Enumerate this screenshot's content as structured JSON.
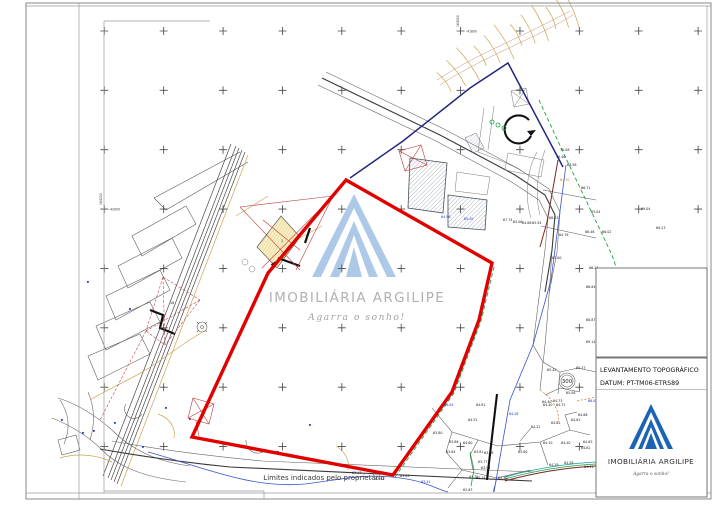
{
  "page": {
    "footer_note": "Limites indicados pelo proprietário",
    "coordinates": {
      "top_vertical": "164300",
      "top_horizontal": "-41800",
      "left_vertical": "164200",
      "left_horizontal": "-42000"
    }
  },
  "watermark": {
    "brand": "IMOBILIÁRIA ARGILIPE",
    "tagline": "Agarra o sonho!"
  },
  "title_block": {
    "doc_type": "LEVANTAMENTO TOPOGRÁFICO",
    "datum": "DATUM: PT-TM06-ETRS89",
    "brand": "IMOBILIÁRIA ARGILIPE",
    "tagline": "Agarra o sonho!"
  },
  "map": {
    "station_label": "300",
    "parcel_number": "16",
    "building_number": "1",
    "grid": {
      "x0": 104.3,
      "y0": 31,
      "dx": 59.38,
      "dy": 59.36,
      "cols": 11,
      "rows": 8,
      "skip_x": 590,
      "skip_y": 262,
      "max_x": 707,
      "max_y": 488,
      "half": 4
    },
    "elevation_labels": [
      {
        "t": "70.08",
        "x": 560,
        "y": 151
      },
      {
        "t": "70.46",
        "x": 556,
        "y": 158
      },
      {
        "t": "68.58",
        "x": 567,
        "y": 166
      },
      {
        "t": "64.70",
        "x": 560,
        "y": 181,
        "c": "o"
      },
      {
        "t": "66.71",
        "x": 581,
        "y": 189
      },
      {
        "t": "68.23",
        "x": 549,
        "y": 219
      },
      {
        "t": "65.04",
        "x": 591,
        "y": 213
      },
      {
        "t": "66.46",
        "x": 585,
        "y": 233
      },
      {
        "t": "66.02",
        "x": 602,
        "y": 233
      },
      {
        "t": "64.76",
        "x": 559,
        "y": 236
      },
      {
        "t": "67.00",
        "x": 552,
        "y": 259
      },
      {
        "t": "66.27",
        "x": 589,
        "y": 269
      },
      {
        "t": "67.74",
        "x": 503,
        "y": 221
      },
      {
        "t": "65.06",
        "x": 513,
        "y": 223
      },
      {
        "t": "64.86",
        "x": 522,
        "y": 224
      },
      {
        "t": "65.94",
        "x": 532,
        "y": 224
      },
      {
        "t": "66.84",
        "x": 586,
        "y": 288
      },
      {
        "t": "68.87",
        "x": 586,
        "y": 321
      },
      {
        "t": "69.14",
        "x": 586,
        "y": 343
      },
      {
        "t": "69.04",
        "x": 641,
        "y": 210
      },
      {
        "t": "69.23",
        "x": 656,
        "y": 229
      },
      {
        "t": "65.42",
        "x": 547,
        "y": 371
      },
      {
        "t": "65.37",
        "x": 576,
        "y": 369
      },
      {
        "t": "65.08",
        "x": 566,
        "y": 394
      },
      {
        "t": "64.73",
        "x": 553,
        "y": 402
      },
      {
        "t": "64.40",
        "x": 542,
        "y": 403
      },
      {
        "t": "64.04",
        "x": 444,
        "y": 406,
        "c": "b"
      },
      {
        "t": "64.81",
        "x": 476,
        "y": 406
      },
      {
        "t": "64.40",
        "x": 543,
        "y": 406
      },
      {
        "t": "64.72",
        "x": 556,
        "y": 406
      },
      {
        "t": "64.52",
        "x": 468,
        "y": 421
      },
      {
        "t": "64.86",
        "x": 578,
        "y": 416
      },
      {
        "t": "64.61",
        "x": 571,
        "y": 421
      },
      {
        "t": "64.62",
        "x": 551,
        "y": 424
      },
      {
        "t": "64.22",
        "x": 531,
        "y": 428
      },
      {
        "t": "63.80",
        "x": 433,
        "y": 434
      },
      {
        "t": "63.86",
        "x": 449,
        "y": 443
      },
      {
        "t": "64.60",
        "x": 463,
        "y": 444
      },
      {
        "t": "64.63",
        "x": 583,
        "y": 443
      },
      {
        "t": "64.82",
        "x": 581,
        "y": 449
      },
      {
        "t": "64.10",
        "x": 543,
        "y": 444
      },
      {
        "t": "64.40",
        "x": 561,
        "y": 444
      },
      {
        "t": "63.84",
        "x": 446,
        "y": 453
      },
      {
        "t": "63.81",
        "x": 474,
        "y": 453
      },
      {
        "t": "63.58",
        "x": 484,
        "y": 454
      },
      {
        "t": "63.80",
        "x": 518,
        "y": 453
      },
      {
        "t": "63.77",
        "x": 478,
        "y": 463
      },
      {
        "t": "63.94",
        "x": 481,
        "y": 469
      },
      {
        "t": "64.28",
        "x": 549,
        "y": 466
      },
      {
        "t": "64.26",
        "x": 564,
        "y": 464
      },
      {
        "t": "64.41",
        "x": 584,
        "y": 468
      },
      {
        "t": "63.79",
        "x": 469,
        "y": 478
      },
      {
        "t": "64.24",
        "x": 476,
        "y": 479
      },
      {
        "t": "63.40",
        "x": 498,
        "y": 479
      },
      {
        "t": "62.63",
        "x": 463,
        "y": 491
      },
      {
        "t": "63.13",
        "x": 352,
        "y": 474
      },
      {
        "t": "62.41",
        "x": 375,
        "y": 480
      },
      {
        "t": "63.63",
        "x": 400,
        "y": 477
      },
      {
        "t": "63.41",
        "x": 421,
        "y": 483,
        "c": "b"
      },
      {
        "t": "64.98",
        "x": 441,
        "y": 218,
        "c": "b"
      },
      {
        "t": "65.20",
        "x": 464,
        "y": 220,
        "c": "b"
      },
      {
        "t": "64.26",
        "x": 509,
        "y": 415,
        "c": "b"
      },
      {
        "t": "66.06",
        "x": 588,
        "y": 402,
        "c": "b"
      }
    ]
  },
  "colors": {
    "boundary_red": "#e10000",
    "survey_red": "#c03a3a",
    "parcel_green": "#1fa04a",
    "water_blue": "#3a55cc",
    "navy": "#26267f",
    "road_tan": "#c9a44e",
    "teal": "#1d9e9e",
    "logo_blue": "#1b63b5",
    "logo_blue_light": "#a9c7e6"
  }
}
